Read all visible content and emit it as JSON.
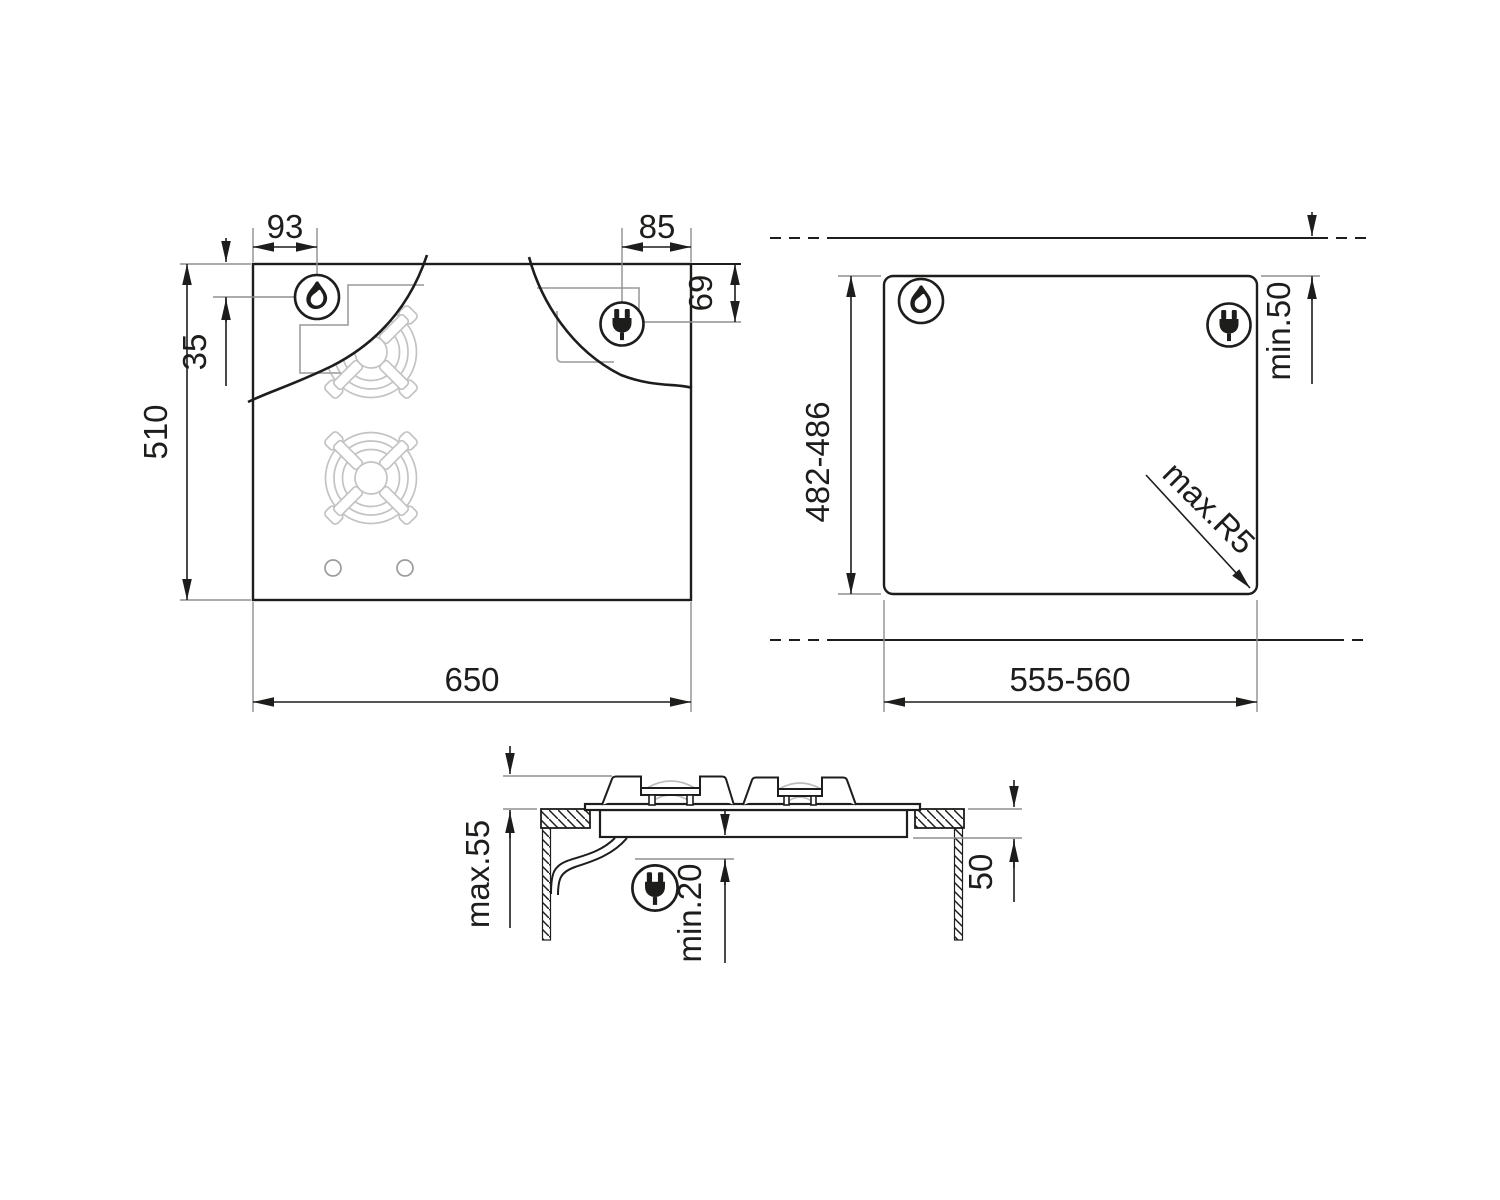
{
  "drawing_title": "hob-installation-dimensions",
  "plan_view": {
    "dims": {
      "gas_offset_x": "93",
      "plug_offset_x": "85",
      "plug_offset_y": "69",
      "gas_offset_y": "35",
      "depth": "510",
      "width": "650"
    }
  },
  "cutout_view": {
    "dims": {
      "depth_range": "482-486",
      "rear_clearance": "min.50",
      "width_range": "555-560",
      "corner_radius": "max.R5"
    }
  },
  "side_view": {
    "dims": {
      "height_above_worktop": "max.55",
      "clearance_below": "min.20",
      "depth_below_worktop": "50"
    }
  },
  "icons": {
    "gas": "flame-icon",
    "electric": "plug-icon"
  },
  "colors": {
    "line": "#1d1d1b",
    "detail": "#bdbdbd",
    "extension": "#8f8f8f",
    "background": "#ffffff"
  }
}
